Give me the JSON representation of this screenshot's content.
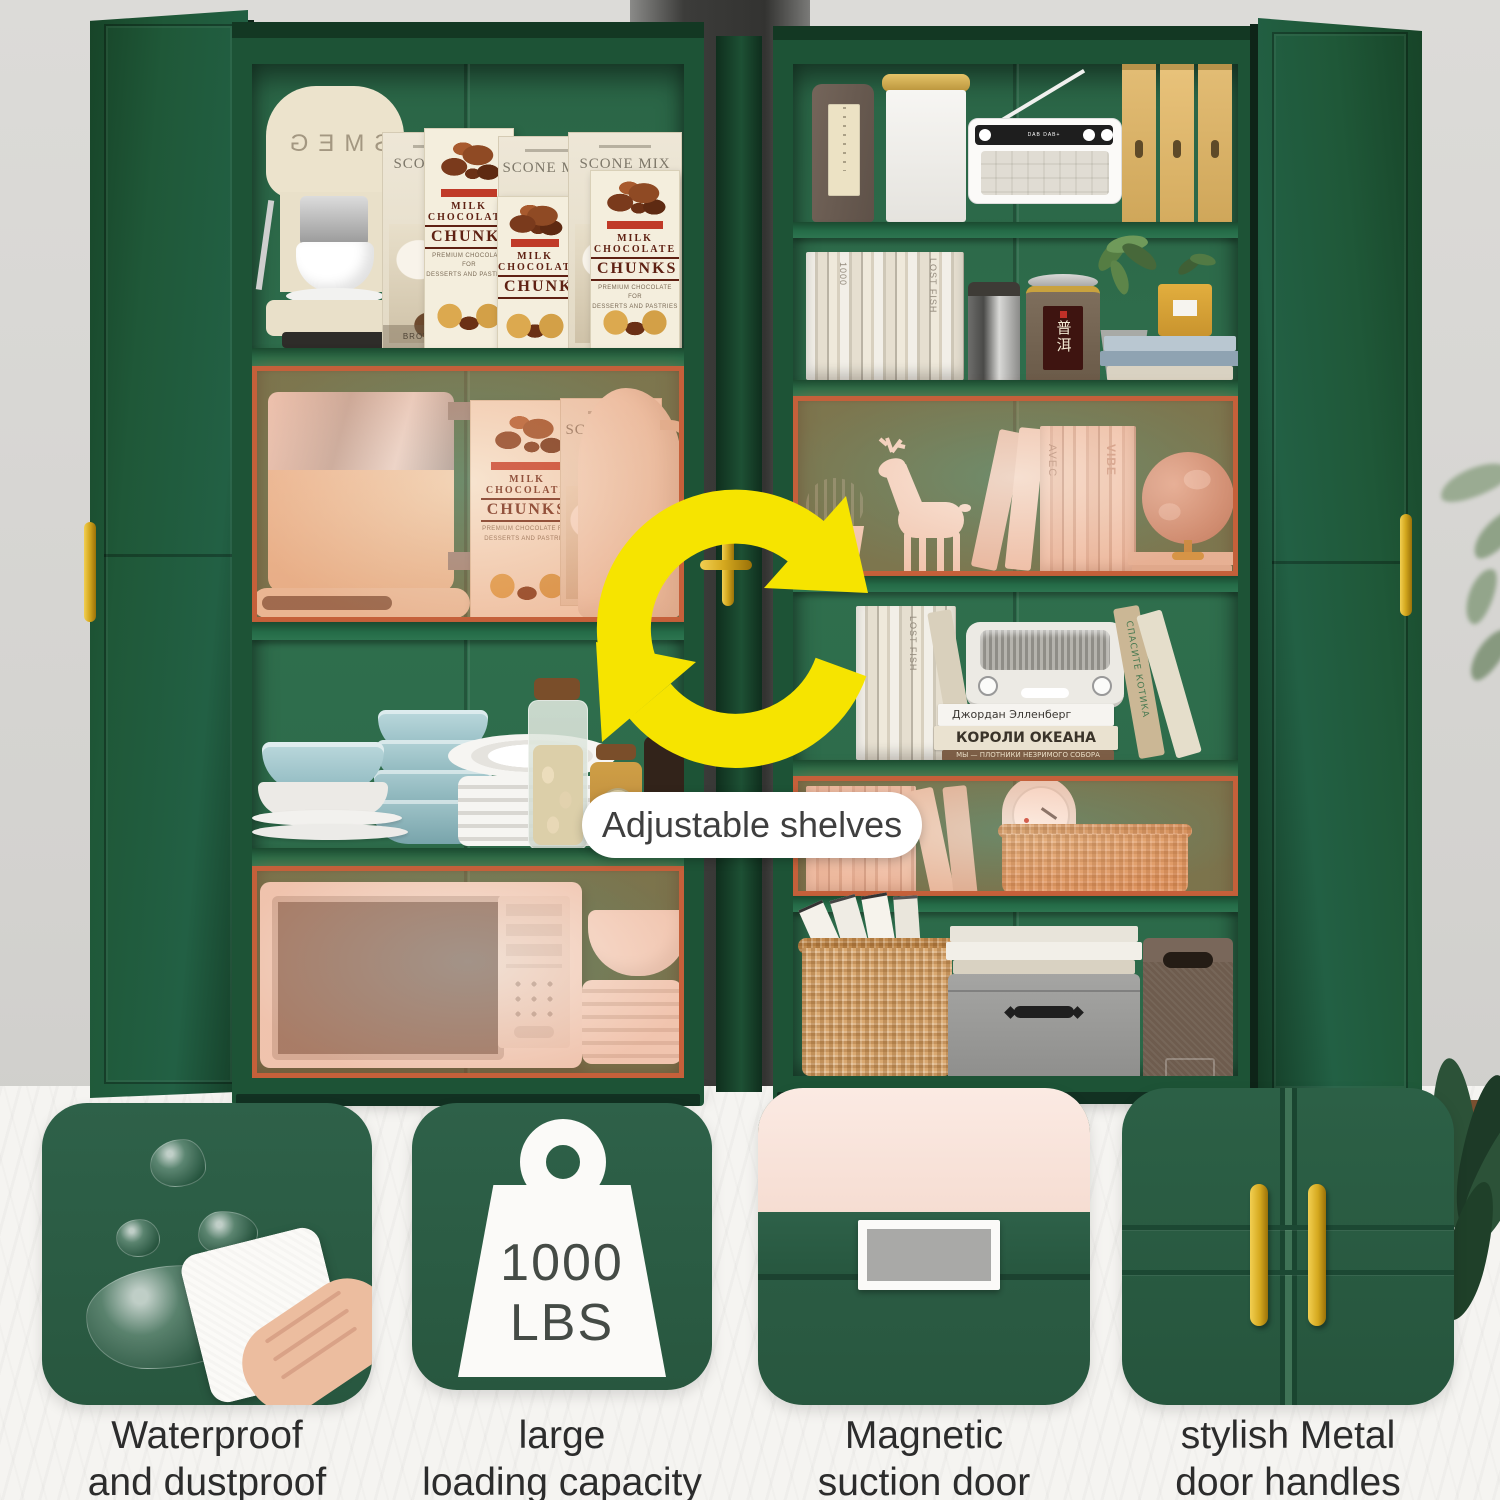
{
  "scene": {
    "annotation_label": "Adjustable shelves"
  },
  "products": {
    "coffee_machine_brand": "SMEG",
    "scone_box": {
      "title": "SCONE MIX",
      "side_note": "BROWN SUGAR"
    },
    "chunks_box": {
      "line1": "MILK",
      "line2": "CHOCOLATE",
      "line3": "CHUNKS",
      "sub1": "PREMIUM CHOCOLATE FOR",
      "sub2": "DESSERTS AND PASTRIES"
    },
    "radio_brand": "DAB DAB+",
    "tea_canister_label": "普洱",
    "book_spines": {
      "thousand": "1000",
      "lost_fish": "LOST FISH",
      "avec": "AVEC",
      "vibe": "VIBE",
      "cat_book": "СПАСИТЕ КОТИКА"
    },
    "russian_books": {
      "author": "Джордан Элленберг",
      "title1": "КОРОЛИ ОКЕАНА",
      "title2": "МЫ — ПЛОТНИКИ НЕЗРИМОГО СОБОРА"
    }
  },
  "features": [
    {
      "line1": "Waterproof",
      "line2": "and dustproof"
    },
    {
      "line1": "large",
      "line2": "loading capacity",
      "badge_value": "1000",
      "badge_unit": "LBS"
    },
    {
      "line1": "Magnetic",
      "line2": "suction door"
    },
    {
      "line1": "stylish Metal",
      "line2": "door handles"
    }
  ],
  "colors": {
    "cabinet_green": "#1d5336",
    "interior_green": "#2e6b4b",
    "highlight_orange": "#c5603a",
    "arrow_yellow": "#f6e400",
    "handle_gold": "#d4a62f",
    "tile_green": "#2d6149",
    "door_pink": "#f8e5dd"
  }
}
